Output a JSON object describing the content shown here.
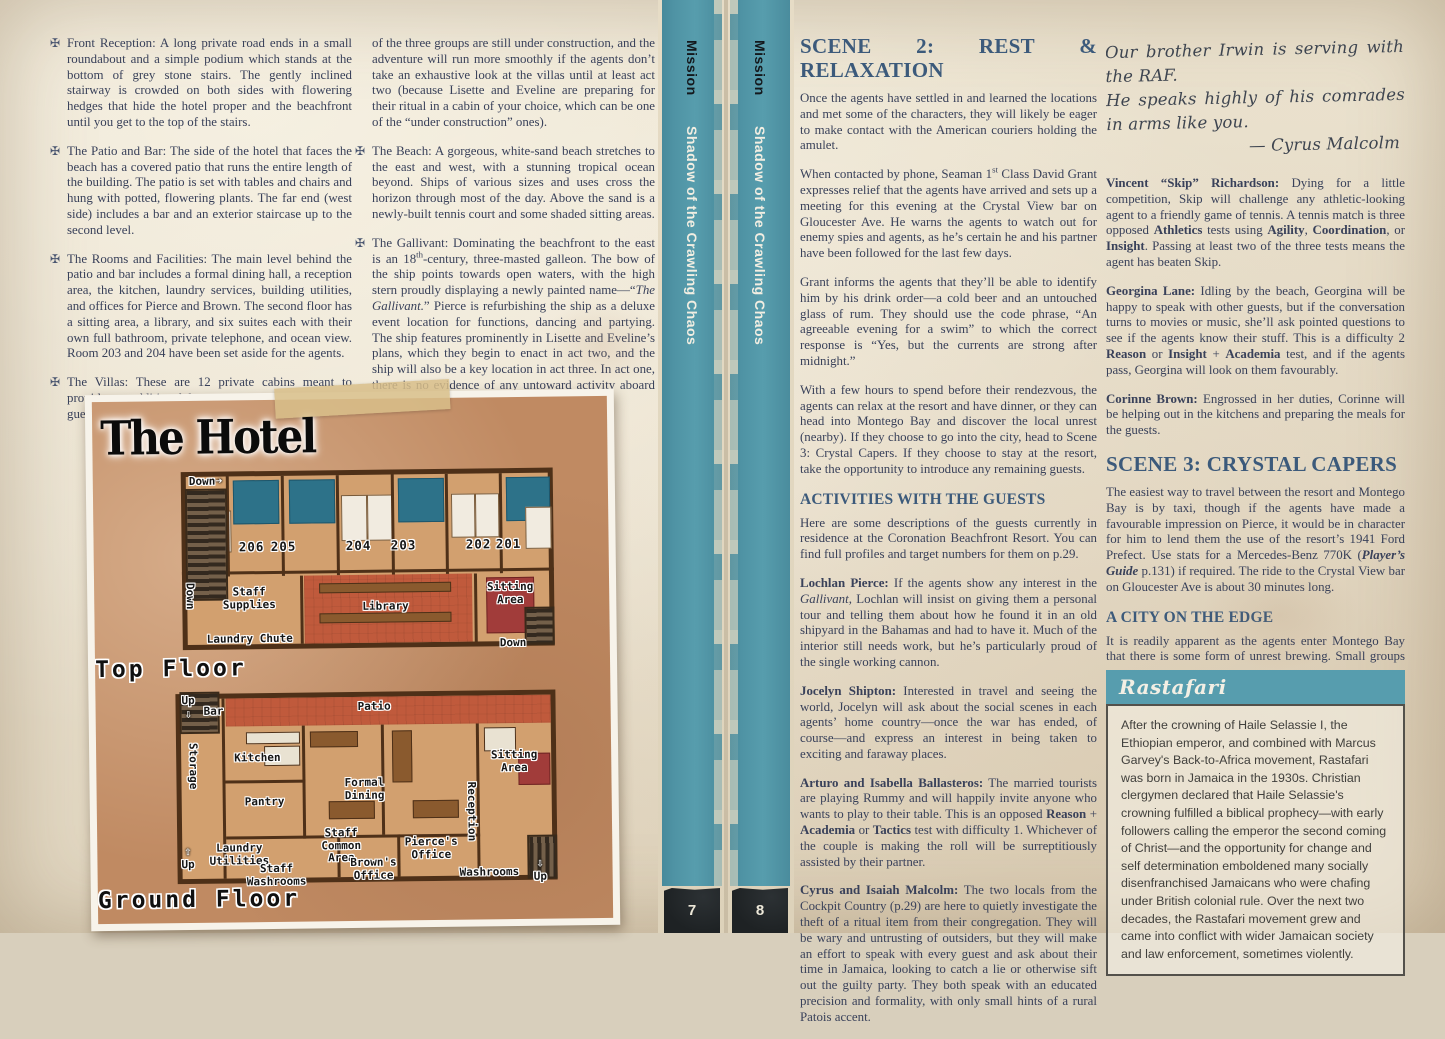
{
  "icons": {
    "bullet": "✠",
    "right_arrow": "➔",
    "up_arrow": "⇧",
    "down_arrow": "⇩"
  },
  "colors": {
    "spine_teal": "#4f93a4",
    "heading_blue": "#3c5a7b",
    "body_ink": "#39415a",
    "paper": "#eae1cd",
    "map_ground": "#c08a62",
    "rasta_header": "#579dae"
  },
  "left_page": {
    "col1_bullets": [
      "Front Reception: A long private road ends in a small roundabout and a simple podium which stands at the bottom of grey stone stairs. The gently inclined stairway is crowded on both sides with flowering hedges that hide the hotel proper and the beachfront until you get to the top of the stairs.",
      "The Patio and Bar: The side of the hotel that faces the beach has a covered patio that runs the entire length of the building. The patio is set with tables and chairs and hung with potted, flowering plants. The far end (west side) includes a bar and an exterior staircase up to the second level.",
      "The Rooms and Facilities: The main level behind the patio and bar includes a formal dining hall, a reception area, the kitchen, laundry services, building utilities, and offices for Pierce and Brown. The second floor has a sitting area, a library, and six suites each with their own full bathroom, private telephone, and ocean view. Room 203 and 204 have been set aside for the agents.",
      "The Villas: These are 12 private cabins meant to provide an additional luxury experience for wealthy guests. Two"
    ],
    "col2_cont": "of the three groups are still under construction, and the adventure will run more smoothly if the agents don’t take an exhaustive look at the villas until at least act two (because Lisette and Eveline are preparing for their ritual in a cabin of your choice, which can be one of the “under construction” ones).",
    "col2_bullet_beach": "The Beach: A gorgeous, white-sand beach stretches to the east and west, with a stunning tropical ocean beyond. Ships of various sizes and uses cross the horizon through most of the day. Above the sand is a newly-built tennis court and some shaded sitting areas.",
    "col2_bullet_gallivant_runs": [
      {
        "t": "The Gallivant: Dominating the beachfront to the east is an 18"
      },
      {
        "t": "th",
        "sup": true
      },
      {
        "t": "-century, three-masted galleon. The bow of the ship points towards open waters, with the high stern proudly displaying a newly painted name—“"
      },
      {
        "t": "The Gallivant.",
        "i": true
      },
      {
        "t": "” Pierce is refurbishing the ship as a deluxe event location for functions, dancing and partying. The ship features prominently in Lisette and Eveline’s plans, which they begin to enact in act two, and the ship will also be a key location in act three. In act one, there is no evidence of any untoward activity aboard it."
      }
    ],
    "map": {
      "title": "The Hotel",
      "top_floor": "Top Floor",
      "ground_floor": "Ground Floor",
      "rooms": [
        "206",
        "205",
        "204",
        "203",
        "202",
        "201"
      ],
      "labels": {
        "down_top": "Down",
        "down_left": "Down",
        "down_right": "Down",
        "staff_supplies": "Staff Supplies",
        "library": "Library",
        "sitting_top": "Sitting Area",
        "laundry_chute": "Laundry Chute",
        "up_top": "Up",
        "bar": "Bar",
        "patio": "Patio",
        "storage": "Storage",
        "kitchen": "Kitchen",
        "pantry": "Pantry",
        "formal_dining": "Formal Dining",
        "sitting_ground": "Sitting Area",
        "reception": "Reception",
        "laundry_utilities": "Laundry Utilities",
        "staff_washrooms": "Staff Washrooms",
        "staff_common": "Staff Common Area",
        "browns_office": "Brown's Office",
        "pierces_office": "Pierce's Office",
        "washrooms": "Washrooms",
        "up_left": "Up",
        "up_right": "Up"
      }
    }
  },
  "spine": {
    "strips": [
      {
        "series": "Mission",
        "title": "Shadow of the Crawling Chaos",
        "page": "7"
      },
      {
        "series": "Mission",
        "title": "Shadow of the Crawling Chaos",
        "page": "8"
      }
    ]
  },
  "right_page": {
    "col1": {
      "scene2_heading": "SCENE 2: REST & RELAXATION",
      "p1": "Once the agents have settled in and learned the locations and met some of the characters, they will likely be eager to make contact with the American couriers holding the amulet.",
      "p2_runs": [
        {
          "t": "When contacted by phone, Seaman 1"
        },
        {
          "t": "st",
          "sup": true
        },
        {
          "t": " Class David Grant expresses relief that the agents have arrived and sets up a meeting for this evening at the Crystal View bar on Gloucester Ave. He warns the agents to watch out for enemy spies and agents, as he’s certain he and his partner have been followed for the last few days."
        }
      ],
      "p3": "Grant informs the agents that they’ll be able to identify him by his drink order—a cold beer and an untouched glass of rum. They should use the code phrase, “An agreeable evening for a swim” to which the correct response is “Yes, but the currents are strong after midnight.”",
      "p4": "With a few hours to spend before their rendezvous, the agents can relax at the resort and have dinner, or they can head into Montego Bay and discover the local unrest (nearby). If they choose to go into the city, head to Scene 3: Crystal Capers. If they choose to stay at the resort, take the opportunity to introduce any remaining guests.",
      "activities_heading": "ACTIVITIES WITH THE GUESTS",
      "p5": "Here are some descriptions of the guests currently in residence at the Coronation Beachfront Resort. You can find full profiles and target numbers for them on p.29.",
      "guests": [
        {
          "runs": [
            {
              "t": "Lochlan Pierce:",
              "b": true
            },
            {
              "t": " If the agents show any interest in the "
            },
            {
              "t": "Gallivant",
              "i": true
            },
            {
              "t": ", Lochlan will insist on giving them a personal tour and telling them about how he found it in an old shipyard in the Bahamas and had to have it. Much of the interior still needs work, but he’s particularly proud of the single working cannon."
            }
          ]
        },
        {
          "runs": [
            {
              "t": "Jocelyn Shipton:",
              "b": true
            },
            {
              "t": " Interested in travel and seeing the world, Jocelyn will ask about the social scenes in each agents’ home country—once the war has ended, of course—and express an interest in being taken to exciting and faraway places."
            }
          ]
        },
        {
          "runs": [
            {
              "t": "Arturo and Isabella Ballasteros:",
              "b": true
            },
            {
              "t": " The married tourists are playing Rummy and will happily invite anyone who wants to play to their table. This is an opposed "
            },
            {
              "t": "Reason",
              "b": true
            },
            {
              "t": " + "
            },
            {
              "t": "Academia",
              "b": true
            },
            {
              "t": " or "
            },
            {
              "t": "Tactics",
              "b": true
            },
            {
              "t": " test with difficulty 1. Whichever of the couple is making the roll will be surreptitiously assisted by their partner."
            }
          ]
        },
        {
          "runs": [
            {
              "t": "Cyrus and Isaiah Malcolm:",
              "b": true
            },
            {
              "t": " The two locals from the Cockpit Country (p.29) are here to quietly investigate the theft of a ritual item from their congregation. They will be wary and untrusting of outsiders, but they will make an effort to speak with every guest and ask about their time in Jamaica, looking to catch a lie or otherwise sift out the guilty party. They both speak with an educated precision and formality, with only small hints of a rural Patois accent."
            }
          ]
        }
      ]
    },
    "col2": {
      "note_line1": "Our brother Irwin is serving with the RAF.",
      "note_line2": "He speaks highly of his comrades in arms like you.",
      "note_sig": "— Cyrus Malcolm",
      "guests": [
        {
          "runs": [
            {
              "t": "Vincent “Skip” Richardson:",
              "b": true
            },
            {
              "t": " Dying for a little competition, Skip will challenge any athletic-looking agent to a friendly game of tennis. A tennis match is three opposed "
            },
            {
              "t": "Athletics",
              "b": true
            },
            {
              "t": " tests using "
            },
            {
              "t": "Agility",
              "b": true
            },
            {
              "t": ", "
            },
            {
              "t": "Coordination",
              "b": true
            },
            {
              "t": ", or "
            },
            {
              "t": "Insight",
              "b": true
            },
            {
              "t": ". Passing at least two of the three tests means the agent has beaten Skip."
            }
          ]
        },
        {
          "runs": [
            {
              "t": "Georgina Lane:",
              "b": true
            },
            {
              "t": " Idling by the beach, Georgina will be happy to speak with other guests, but if the conversation turns to movies or music, she’ll ask pointed questions to see if the agents know their stuff. This is a difficulty 2 "
            },
            {
              "t": "Reason",
              "b": true
            },
            {
              "t": " or "
            },
            {
              "t": "Insight",
              "b": true
            },
            {
              "t": " + "
            },
            {
              "t": "Academia",
              "b": true
            },
            {
              "t": " test, and if the agents pass, Georgina will look on them favourably."
            }
          ]
        },
        {
          "runs": [
            {
              "t": "Corinne Brown:",
              "b": true
            },
            {
              "t": " Engrossed in her duties, Corinne will be helping out in the kitchens and preparing the meals for the guests."
            }
          ]
        }
      ],
      "scene3_heading": "SCENE 3: CRYSTAL CAPERS",
      "scene3_runs": [
        {
          "t": "The easiest way to travel between the resort and Montego Bay is by taxi, though if the agents have made a favourable impression on Pierce, it would be in character for him to lend them the use of the resort’s 1941 Ford Prefect. Use stats for a Mercedes-Benz 770K ("
        },
        {
          "t": "Player’s Guide",
          "b": true,
          "i": true
        },
        {
          "t": " p.131) if required. The ride to the Crystal View bar on Gloucester Ave is about 30 minutes long."
        }
      ],
      "city_heading": "A CITY ON THE EDGE",
      "city_p": "It is readily apparent as the agents enter Montego Bay that there is some form of unrest brewing. Small groups of men and women gather on street corners and in public spaces with an aggressive set to their shoulders and faces. Many of them have their hair in dreadlocks and wear colourful shawls and hair coverings. Small groups of police officers, most of them British, watch these groups with unease, but violence or confrontation seems unlikely at least while the sun is up.",
      "box": {
        "title": "Rastafari",
        "text": "After the crowning of Haile Selassie I, the Ethiopian emperor, and combined with Marcus Garvey's Back-to-Africa movement, Rastafari was born in Jamaica in the 1930s. Christian clergymen declared that Haile Selassie's crowning fulfilled a biblical prophecy—with early followers calling the emperor the second coming of Christ—and the opportunity for change and self determination emboldened many socially disenfranchised Jamaicans who were chafing under British colonial rule. Over the next two decades, the Rastafari movement grew and came into conflict with wider Jamaican society and law enforcement, sometimes violently."
      }
    }
  }
}
